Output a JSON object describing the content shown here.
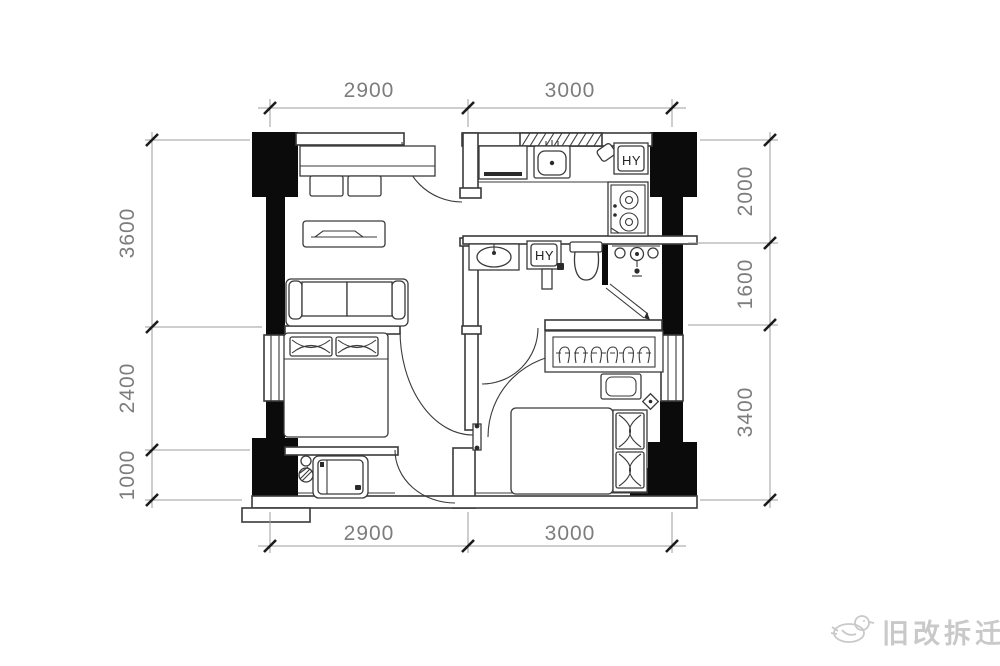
{
  "colors": {
    "wall_fill": "#0b0b0b",
    "plan_line": "#3a3a3a",
    "dim_text": "#7d7d7d",
    "watermark": "#c9c9c9"
  },
  "dimensions": {
    "top": [
      "2900",
      "3000"
    ],
    "bottom": [
      "2900",
      "3000"
    ],
    "left": [
      "3600",
      "2400",
      "1000"
    ],
    "right": [
      "2000",
      "1600",
      "3400"
    ]
  },
  "labels": {
    "water_heater_kitchen": "HY",
    "water_heater_bath": "HY"
  },
  "watermark": {
    "text": "旧改拆迁"
  }
}
